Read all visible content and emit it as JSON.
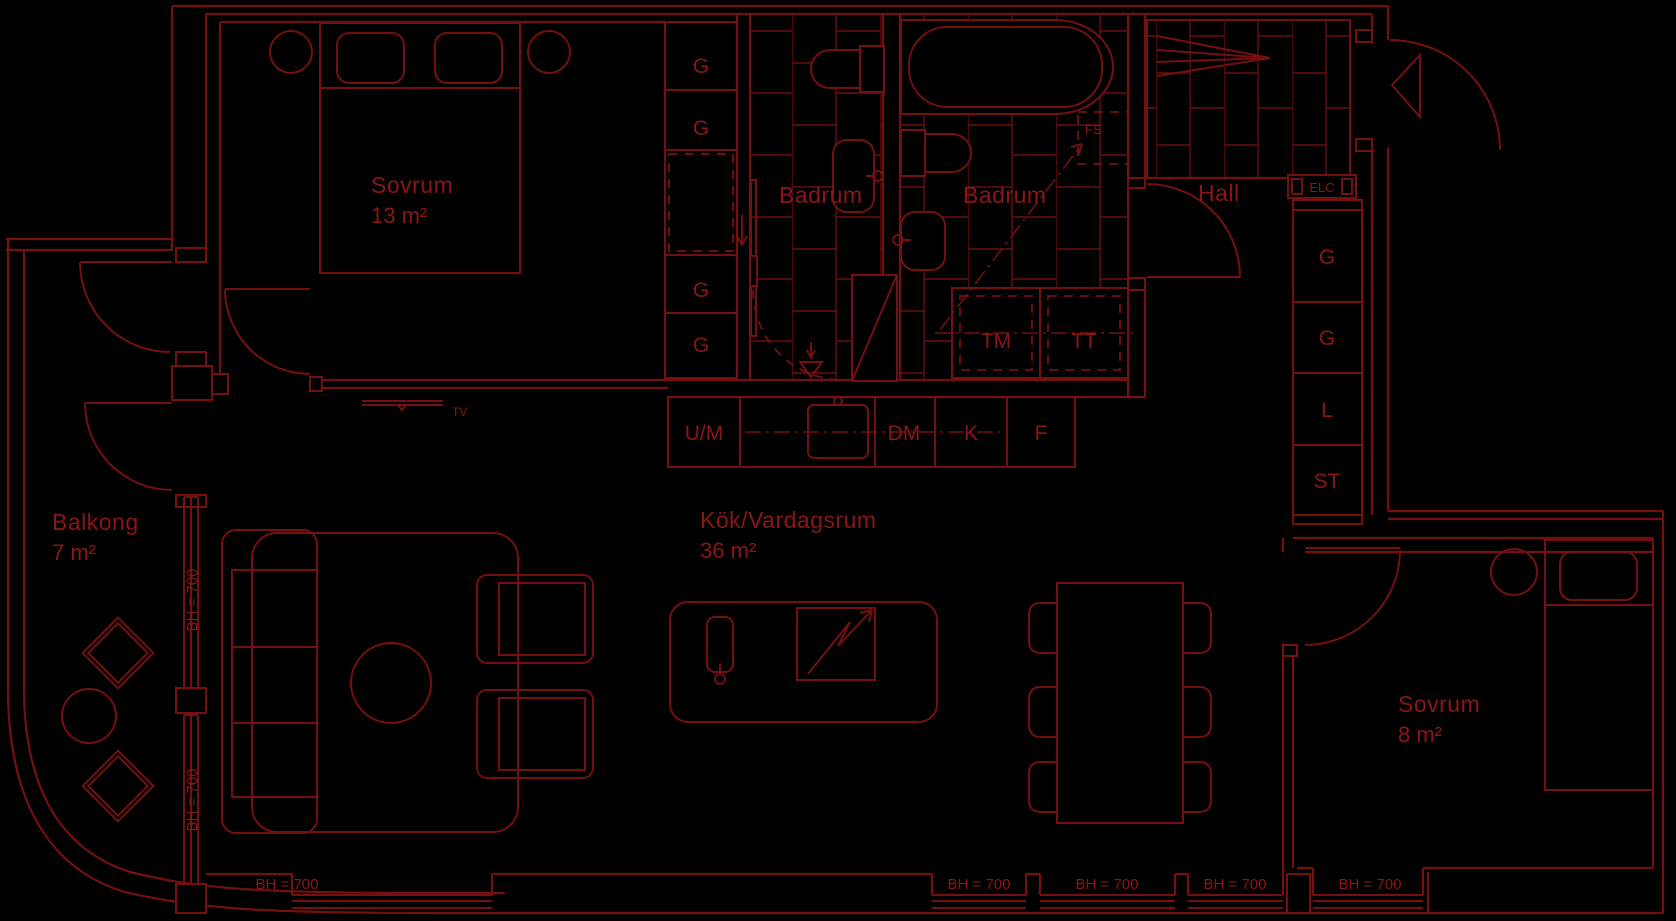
{
  "plan_type": "apartment-floor-plan",
  "language": "sv",
  "colors": {
    "background": "#000000",
    "line": "#741010",
    "text": "#8c1616"
  },
  "rooms": {
    "bedroom_main": {
      "name": "Sovrum",
      "area": "13 m²"
    },
    "bathroom_1": {
      "name": "Badrum"
    },
    "bathroom_2": {
      "name": "Badrum"
    },
    "hall": {
      "name": "Hall"
    },
    "balcony": {
      "name": "Balkong",
      "area": "7 m²"
    },
    "kitchen_living": {
      "name": "Kök/Vardagsrum",
      "area": "36 m²"
    },
    "bedroom_small": {
      "name": "Sovrum",
      "area": "8 m²"
    }
  },
  "storage": {
    "wardrobe": "G",
    "linen_closet": "L",
    "cleaning_closet": "ST",
    "electrical_cabinet": "ELC",
    "fan_unit": "FS"
  },
  "appliances": {
    "oven_microwave": "U/M",
    "dishwasher": "DM",
    "fridge": "K",
    "freezer": "F",
    "washing_machine": "TM",
    "tumble_dryer": "TT",
    "tv": "TV"
  },
  "annotations": {
    "window_sill_height": "BH = 700"
  }
}
